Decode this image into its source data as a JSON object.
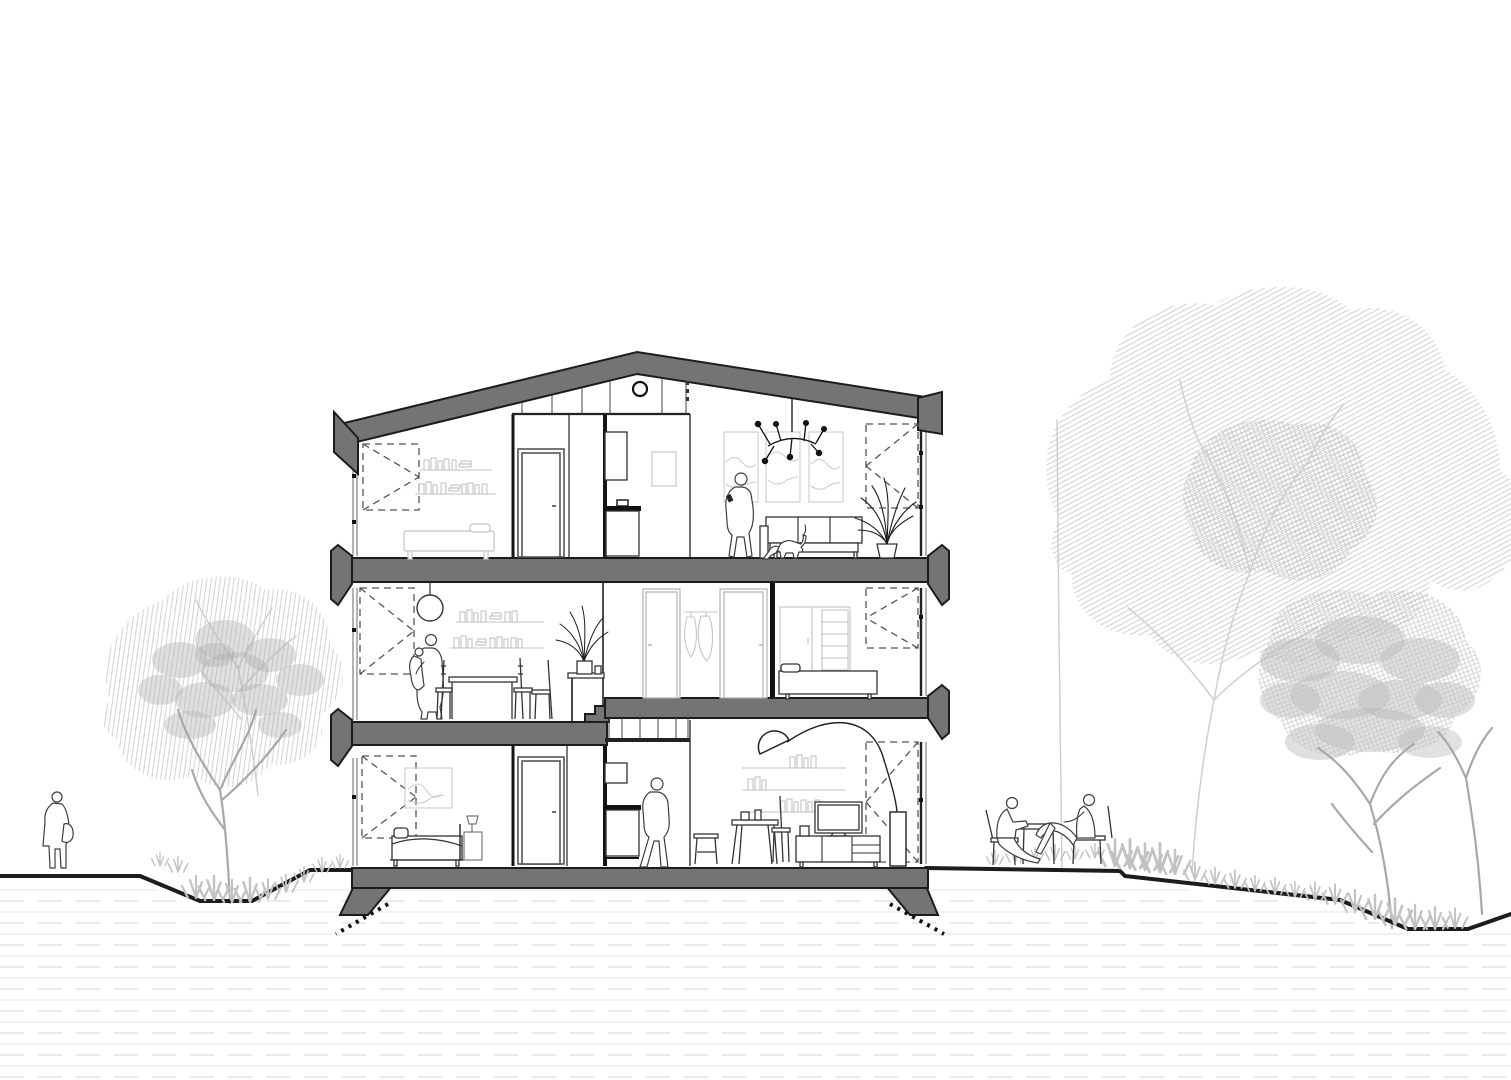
{
  "drawing": {
    "type": "architectural-cross-section",
    "title": "Cross-section of a three-storey split-level house with trees and figures"
  },
  "colors": {
    "line": "#1c1c1c",
    "poche": "#747474",
    "furniture_light": "#c3c3c3",
    "figure_line": "#3d3d3d",
    "vegetation_light": "#cfcfcf",
    "vegetation_mid": "#b9b9b9",
    "ground_hatch_a": "#e3e3e3",
    "ground_hatch_b": "#d6d6d6",
    "dash": "#555555",
    "background": "#ffffff"
  },
  "building": {
    "storeys": [
      {
        "name": "top floor",
        "rooms": [
          {
            "name": "bedroom",
            "contents": [
              "casement-window-symbol",
              "book-shelves",
              "bed"
            ]
          },
          {
            "name": "hallway",
            "contents": [
              "door",
              "high-cabinet",
              "washstand-cabinet",
              "framed-picture",
              "clerestory-band",
              "porthole-window"
            ]
          },
          {
            "name": "living-room",
            "contents": [
              "wall-art-panels",
              "chandelier",
              "sofa",
              "palm-plant",
              "casement-window-symbol"
            ],
            "occupants": [
              "standing-person",
              "dog"
            ]
          }
        ]
      },
      {
        "name": "middle floor",
        "rooms": [
          {
            "name": "dining-room",
            "contents": [
              "casement-window-symbol",
              "pendant-globe-lamp",
              "book-shelves",
              "dining-table",
              "chairs",
              "palm-on-counter",
              "steps-to-upper-level"
            ],
            "occupants": [
              "adult-carrying-child"
            ]
          },
          {
            "name": "hallway",
            "contents": [
              "door",
              "door",
              "hanging-clothes"
            ]
          },
          {
            "name": "bedroom",
            "contents": [
              "wardrobe",
              "daybed",
              "casement-window-symbol"
            ]
          }
        ]
      },
      {
        "name": "ground floor",
        "rooms": [
          {
            "name": "bedroom",
            "contents": [
              "casement-window-symbol",
              "framed-picture",
              "bed",
              "nightstand-with-lamp",
              "door"
            ]
          },
          {
            "name": "hallway",
            "contents": [
              "high-cabinet",
              "counter-cabinet",
              "transom-glazing",
              "stool"
            ],
            "occupants": [
              "walking-person"
            ]
          },
          {
            "name": "living-room",
            "contents": [
              "arc-floor-lamp",
              "book-shelves",
              "coffee-table",
              "chair",
              "tv-sideboard",
              "casement-window-symbol"
            ]
          }
        ]
      }
    ],
    "structure": [
      "gabled-roof",
      "floor-slabs-with-cantilever-caps",
      "split-level-slab",
      "foundation-with-footings",
      "dotted-excavation-marks"
    ]
  },
  "exterior": {
    "left": [
      "standing-person-with-bag",
      "hatched-tree-pair-in-swale",
      "grass-tufts"
    ],
    "right": [
      "two-people-seated-at-garden-table",
      "large-hatched-tree",
      "small-dense-tree",
      "grass-tufts",
      "sloping-terrain"
    ]
  },
  "window_symbols": [
    {
      "x": 363,
      "y": 444,
      "w": 56,
      "h": 66,
      "apex": "right"
    },
    {
      "x": 866,
      "y": 424,
      "w": 52,
      "h": 84,
      "apex": "left"
    },
    {
      "x": 360,
      "y": 588,
      "w": 54,
      "h": 86,
      "apex": "right"
    },
    {
      "x": 866,
      "y": 588,
      "w": 52,
      "h": 60,
      "apex": "left"
    },
    {
      "x": 362,
      "y": 756,
      "w": 54,
      "h": 82,
      "apex": "right"
    },
    {
      "x": 866,
      "y": 742,
      "w": 52,
      "h": 120,
      "apex": "left"
    }
  ],
  "subsurface_hatch": {
    "top": 890,
    "spacing": 11,
    "count": 18,
    "x1": 0,
    "x2": 1511
  },
  "grass_tufts": {
    "left": [
      [
        160,
        866,
        1.2
      ],
      [
        178,
        872,
        1.4
      ],
      [
        196,
        898,
        2.0
      ],
      [
        214,
        900,
        2.2
      ],
      [
        232,
        902,
        2.0
      ],
      [
        250,
        902,
        2.2
      ],
      [
        268,
        899,
        1.8
      ],
      [
        286,
        892,
        1.6
      ],
      [
        304,
        882,
        1.4
      ],
      [
        322,
        872,
        1.3
      ],
      [
        340,
        868,
        1.2
      ]
    ],
    "right": [
      [
        995,
        864,
        1.2
      ],
      [
        1015,
        862,
        1.3
      ],
      [
        1035,
        861,
        1.2
      ],
      [
        1055,
        860,
        1.4
      ],
      [
        1075,
        859,
        1.2
      ],
      [
        1095,
        858,
        1.3
      ],
      [
        1115,
        866,
        2.4
      ],
      [
        1130,
        868,
        2.6
      ],
      [
        1145,
        870,
        2.4
      ],
      [
        1160,
        872,
        2.6
      ],
      [
        1175,
        874,
        2.2
      ],
      [
        1195,
        880,
        1.6
      ],
      [
        1215,
        884,
        1.5
      ],
      [
        1235,
        888,
        1.6
      ],
      [
        1255,
        891,
        1.4
      ],
      [
        1275,
        894,
        1.5
      ],
      [
        1295,
        897,
        1.4
      ],
      [
        1315,
        900,
        1.6
      ],
      [
        1335,
        904,
        1.8
      ],
      [
        1355,
        912,
        2.0
      ],
      [
        1375,
        919,
        2.2
      ],
      [
        1395,
        925,
        2.4
      ],
      [
        1415,
        929,
        2.2
      ],
      [
        1435,
        929,
        2.0
      ],
      [
        1455,
        928,
        1.8
      ]
    ]
  }
}
